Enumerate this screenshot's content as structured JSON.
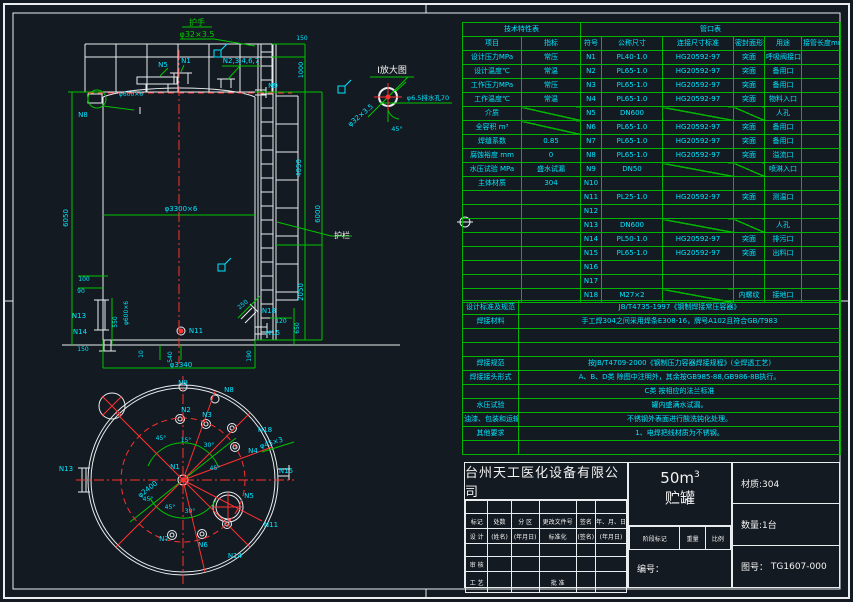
{
  "colors": {
    "line_green": "#00c400",
    "text_cyan": "#00e5ff",
    "line_white": "#e9edf0",
    "centerline_red": "#ff3030",
    "background": "#141a21"
  },
  "tech_table": {
    "title": "技术特性表",
    "headers": [
      "项目",
      "指标"
    ],
    "rows": [
      [
        "设计压力MPa",
        "常压"
      ],
      [
        "设计温度℃",
        "常温"
      ],
      [
        "工作压力MPa",
        "常压"
      ],
      [
        "工作温度℃",
        "常温"
      ],
      [
        "介质",
        ""
      ],
      [
        "全容积 m³",
        ""
      ],
      [
        "焊缝系数",
        "0.85"
      ],
      [
        "腐蚀裕度 mm",
        "0"
      ],
      [
        "水压试验 MPa",
        "盛水试漏"
      ],
      [
        "主体材质",
        "304"
      ]
    ],
    "diag_value_rows": [
      4,
      5
    ]
  },
  "nozzle_table": {
    "title": "管口表",
    "headers": [
      "符号",
      "公称尺寸",
      "连接尺寸标准",
      "密封面形式",
      "用途",
      "接管长度mm"
    ],
    "rows": [
      [
        "N1",
        "PL40-1.0",
        "HG20592-97",
        "突面",
        "呼吸阀接口",
        ""
      ],
      [
        "N2",
        "PL65-1.0",
        "HG20592-97",
        "突面",
        "备用口",
        ""
      ],
      [
        "N3",
        "PL65-1.0",
        "HG20592-97",
        "突面",
        "备用口",
        ""
      ],
      [
        "N4",
        "PL65-1.0",
        "HG20592-97",
        "突面",
        "物料入口",
        ""
      ],
      [
        "N5",
        "DN600",
        "",
        "",
        "人孔",
        ""
      ],
      [
        "N6",
        "PL65-1.0",
        "HG20592-97",
        "突面",
        "备用口",
        ""
      ],
      [
        "N7",
        "PL65-1.0",
        "HG20592-97",
        "突面",
        "备用口",
        ""
      ],
      [
        "N8",
        "PL65-1.0",
        "HG20592-97",
        "突面",
        "溢流口",
        ""
      ],
      [
        "N9",
        "DN50",
        "",
        "",
        "喷淋入口",
        ""
      ],
      [
        "N10",
        "",
        "",
        "",
        "",
        ""
      ],
      [
        "N11",
        "PL25-1.0",
        "HG20592-97",
        "突面",
        "测温口",
        ""
      ],
      [
        "N12",
        "",
        "",
        "",
        "",
        ""
      ],
      [
        "N13",
        "DN600",
        "",
        "",
        "人孔",
        ""
      ],
      [
        "N14",
        "PL50-1.0",
        "HG20592-97",
        "突面",
        "排污口",
        ""
      ],
      [
        "N15",
        "PL65-1.0",
        "HG20592-97",
        "突面",
        "出料口",
        ""
      ],
      [
        "N16",
        "",
        "",
        "",
        "",
        ""
      ],
      [
        "N17",
        "",
        "",
        "",
        "",
        ""
      ],
      [
        "N18",
        "M27×2",
        "",
        "内螺纹",
        "接地口",
        ""
      ]
    ]
  },
  "requirements": {
    "rows": [
      [
        "设计标准及规范",
        "JB/T4735-1997《钢制焊接常压容器》"
      ],
      [
        "焊接材料",
        "手工焊304之间采用焊条E308-16，牌号A102且符合GB/T983"
      ],
      [
        "",
        ""
      ],
      [
        "",
        ""
      ],
      [
        "焊接规范",
        "按JB/T4709-2000《钢制压力容器焊接规程》(全焊透工艺)"
      ],
      [
        "焊接接头形式",
        "A、B、D类 除图中注明外，其余按GB985-88,GB986-8B执行。"
      ],
      [
        "",
        "C类  按相应的法兰标准"
      ],
      [
        "水压试验",
        "罐内盛满水试漏。"
      ],
      [
        "油漆、包装和运输",
        "不锈钢外表面进行酸洗钝化处理。"
      ],
      [
        "其他要求",
        "1、电焊把线材质为不锈钢。"
      ],
      [
        "",
        ""
      ]
    ]
  },
  "title_block": {
    "company": "台州天工医化设备有限公司",
    "volume": "50m",
    "volume_sup": "3",
    "product": "贮罐",
    "material": "材质:304",
    "quantity": "数量:1台",
    "drawing_no_label": "图号：",
    "drawing_no": "TG1607-000",
    "serial_label": "编号：",
    "stage_row": [
      "阶段标记",
      "重量",
      "比例"
    ],
    "grid": [
      [
        "",
        "",
        "",
        "",
        "",
        ""
      ],
      [
        "标记",
        "处数",
        "分 区",
        "更改文件号",
        "签名",
        "年、月、日"
      ],
      [
        "设 计",
        "(姓名)",
        "(年月日)",
        "标准化",
        "(签名)",
        "(年月日)"
      ],
      [
        "",
        "",
        "",
        "",
        "",
        ""
      ],
      [
        "审 核",
        "",
        "",
        "",
        "",
        ""
      ],
      [
        "工 艺",
        "",
        "",
        "批 准",
        "",
        ""
      ]
    ]
  },
  "drawing": {
    "labels": [
      {
        "t": "护手",
        "x": 197,
        "y": 25,
        "c": "gr",
        "s": 8
      },
      {
        "t": "φ32×3.5",
        "x": 197,
        "y": 37,
        "c": "gr",
        "s": 8
      },
      {
        "t": "N5",
        "x": 163,
        "y": 67,
        "c": "cy"
      },
      {
        "t": "N1",
        "x": 186,
        "y": 63,
        "c": "cy"
      },
      {
        "t": "N2,3,4,6,7",
        "x": 241,
        "y": 63,
        "c": "cy"
      },
      {
        "t": "N9",
        "x": 273,
        "y": 88,
        "c": "cy"
      },
      {
        "t": "N8",
        "x": 83,
        "y": 117,
        "c": "cy"
      },
      {
        "t": "Ⅰ",
        "x": 140,
        "y": 114,
        "c": "wh",
        "s": 10
      },
      {
        "t": "φ600×6",
        "x": 131,
        "y": 96,
        "c": "cy",
        "s": 6
      },
      {
        "t": "Ⅰ放大图",
        "x": 392,
        "y": 73,
        "c": "wh",
        "s": 9
      },
      {
        "t": "φ32×3.5",
        "x": 362,
        "y": 117,
        "c": "cy",
        "r": -40
      },
      {
        "t": "φ6.5排水孔70",
        "x": 428,
        "y": 100,
        "c": "cy",
        "s": 6.5
      },
      {
        "t": "45°",
        "x": 397,
        "y": 131,
        "c": "cy",
        "s": 6.5
      },
      {
        "t": "φ3300×6",
        "x": 181,
        "y": 211,
        "c": "cy"
      },
      {
        "t": "6050",
        "x": 68,
        "y": 218,
        "c": "cy",
        "r": -90
      },
      {
        "t": "150",
        "x": 302,
        "y": 40,
        "c": "cy",
        "s": 6
      },
      {
        "t": "1000",
        "x": 303,
        "y": 70,
        "c": "cy",
        "r": -90,
        "s": 6.5
      },
      {
        "t": "4050",
        "x": 301,
        "y": 168,
        "c": "cy",
        "r": -90
      },
      {
        "t": "6000",
        "x": 320,
        "y": 214,
        "c": "cy",
        "r": -90
      },
      {
        "t": "护栏",
        "x": 342,
        "y": 238,
        "c": "wh",
        "s": 8
      },
      {
        "t": "2050",
        "x": 303,
        "y": 292,
        "c": "cy",
        "r": -90
      },
      {
        "t": "100",
        "x": 84,
        "y": 281,
        "c": "cy",
        "s": 6
      },
      {
        "t": "90",
        "x": 81,
        "y": 293,
        "c": "cy",
        "s": 6
      },
      {
        "t": "N13",
        "x": 79,
        "y": 318,
        "c": "cy"
      },
      {
        "t": "550",
        "x": 117,
        "y": 322,
        "c": "cy",
        "r": -90,
        "s": 6
      },
      {
        "t": "φ600×6",
        "x": 128,
        "y": 313,
        "c": "cy",
        "r": -90,
        "s": 6
      },
      {
        "t": "N14",
        "x": 80,
        "y": 334,
        "c": "cy"
      },
      {
        "t": "150",
        "x": 83,
        "y": 351,
        "c": "cy",
        "s": 6
      },
      {
        "t": "N11",
        "x": 196,
        "y": 333,
        "c": "cy"
      },
      {
        "t": "10",
        "x": 143,
        "y": 354,
        "c": "cy",
        "r": -90,
        "s": 6
      },
      {
        "t": "540",
        "x": 172,
        "y": 357,
        "c": "cy",
        "r": -90,
        "s": 6
      },
      {
        "t": "φ3340",
        "x": 181,
        "y": 367,
        "c": "cy"
      },
      {
        "t": "N9",
        "x": 183,
        "y": 385,
        "c": "cy"
      },
      {
        "t": "250",
        "x": 244,
        "y": 306,
        "c": "cy",
        "r": -40,
        "s": 6
      },
      {
        "t": "N18",
        "x": 269,
        "y": 313,
        "c": "cy"
      },
      {
        "t": "120",
        "x": 281,
        "y": 323,
        "c": "cy",
        "s": 6
      },
      {
        "t": "650",
        "x": 299,
        "y": 328,
        "c": "cy",
        "r": -90,
        "s": 6
      },
      {
        "t": "N15",
        "x": 273,
        "y": 335,
        "c": "cy"
      },
      {
        "t": "190",
        "x": 251,
        "y": 356,
        "c": "cy",
        "r": -90,
        "s": 6
      },
      {
        "t": "N2",
        "x": 186,
        "y": 412,
        "c": "cy"
      },
      {
        "t": "N3",
        "x": 207,
        "y": 417,
        "c": "cy"
      },
      {
        "t": "N8",
        "x": 229,
        "y": 392,
        "c": "cy"
      },
      {
        "t": "N18",
        "x": 265,
        "y": 432,
        "c": "cy"
      },
      {
        "t": "N4",
        "x": 253,
        "y": 453,
        "c": "cy"
      },
      {
        "t": "N13",
        "x": 66,
        "y": 471,
        "c": "cy"
      },
      {
        "t": "N15",
        "x": 286,
        "y": 473,
        "c": "cy"
      },
      {
        "t": "N1",
        "x": 175,
        "y": 469,
        "c": "cy"
      },
      {
        "t": "N5",
        "x": 249,
        "y": 498,
        "c": "cy"
      },
      {
        "t": "N11",
        "x": 271,
        "y": 527,
        "c": "cy"
      },
      {
        "t": "N7",
        "x": 164,
        "y": 541,
        "c": "cy"
      },
      {
        "t": "N6",
        "x": 203,
        "y": 547,
        "c": "cy"
      },
      {
        "t": "N14",
        "x": 235,
        "y": 558,
        "c": "cy"
      },
      {
        "t": "φ2400",
        "x": 149,
        "y": 491,
        "c": "cy",
        "r": -38
      },
      {
        "t": "φ45×3",
        "x": 272,
        "y": 445,
        "c": "cy",
        "r": -18
      },
      {
        "t": "45°",
        "x": 161,
        "y": 440,
        "c": "cy",
        "s": 6
      },
      {
        "t": "15°",
        "x": 186,
        "y": 442,
        "c": "cy",
        "s": 6
      },
      {
        "t": "30°",
        "x": 209,
        "y": 447,
        "c": "cy",
        "s": 6
      },
      {
        "t": "45°",
        "x": 215,
        "y": 470,
        "c": "cy",
        "s": 6
      },
      {
        "t": "45°",
        "x": 148,
        "y": 501,
        "c": "cy",
        "s": 6
      },
      {
        "t": "45°",
        "x": 170,
        "y": 509,
        "c": "cy",
        "s": 6
      },
      {
        "t": "30°",
        "x": 190,
        "y": 513,
        "c": "cy",
        "s": 6
      }
    ]
  }
}
